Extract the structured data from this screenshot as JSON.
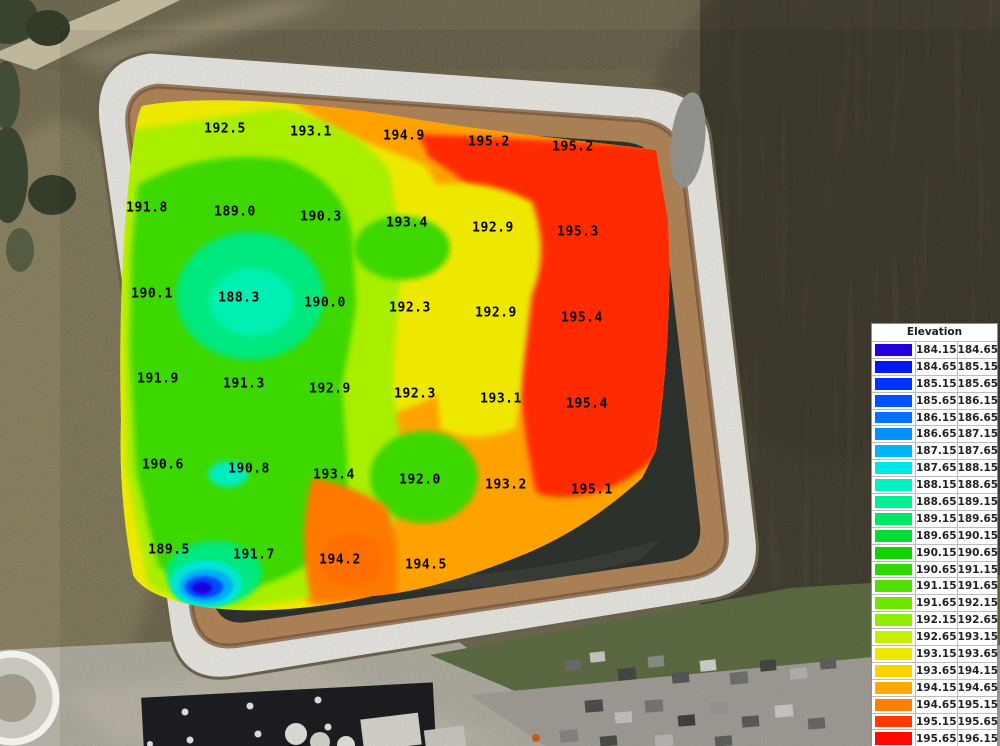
{
  "page": {
    "type": "elevation-survey-heatmap-over-aerial-photo",
    "accent_colors": {
      "legend_border": "#8f8f8f",
      "label_text": "#000000"
    }
  },
  "chart_data": {
    "type": "heatmap",
    "title": "Elevation",
    "legend_position": "right",
    "value_range": [
      184.15,
      196.15
    ],
    "bin_size": 0.5,
    "legend_bins": [
      {
        "from": "184.15",
        "to": "184.65",
        "color": "#2000DD"
      },
      {
        "from": "184.65",
        "to": "185.15",
        "color": "#0018F2"
      },
      {
        "from": "185.15",
        "to": "185.65",
        "color": "#0034FF"
      },
      {
        "from": "185.65",
        "to": "186.15",
        "color": "#0052FF"
      },
      {
        "from": "186.15",
        "to": "186.65",
        "color": "#0072FF"
      },
      {
        "from": "186.65",
        "to": "187.15",
        "color": "#0092FC"
      },
      {
        "from": "187.15",
        "to": "187.65",
        "color": "#00B6F5"
      },
      {
        "from": "187.65",
        "to": "188.15",
        "color": "#00E6E6"
      },
      {
        "from": "188.15",
        "to": "188.65",
        "color": "#00F2C0"
      },
      {
        "from": "188.65",
        "to": "189.15",
        "color": "#00EE94"
      },
      {
        "from": "189.15",
        "to": "189.65",
        "color": "#00E766"
      },
      {
        "from": "189.65",
        "to": "190.15",
        "color": "#00DD38"
      },
      {
        "from": "190.15",
        "to": "190.65",
        "color": "#10D400"
      },
      {
        "from": "190.65",
        "to": "191.15",
        "color": "#2ED900"
      },
      {
        "from": "191.15",
        "to": "191.65",
        "color": "#4EE000"
      },
      {
        "from": "191.65",
        "to": "192.15",
        "color": "#6EE800"
      },
      {
        "from": "192.15",
        "to": "192.65",
        "color": "#92EE00"
      },
      {
        "from": "192.65",
        "to": "193.15",
        "color": "#C8EE00"
      },
      {
        "from": "193.15",
        "to": "193.65",
        "color": "#EEE800"
      },
      {
        "from": "193.65",
        "to": "194.15",
        "color": "#FFD300"
      },
      {
        "from": "194.15",
        "to": "194.65",
        "color": "#FFA800"
      },
      {
        "from": "194.65",
        "to": "195.15",
        "color": "#FF7F00"
      },
      {
        "from": "195.15",
        "to": "195.65",
        "color": "#FF3A00"
      },
      {
        "from": "195.65",
        "to": "196.15",
        "color": "#FF0A00"
      }
    ],
    "points": [
      {
        "value": "192.5",
        "x": 225,
        "y": 129
      },
      {
        "value": "193.1",
        "x": 311,
        "y": 132
      },
      {
        "value": "194.9",
        "x": 404,
        "y": 136
      },
      {
        "value": "195.2",
        "x": 489,
        "y": 142
      },
      {
        "value": "195.2",
        "x": 573,
        "y": 147
      },
      {
        "value": "191.8",
        "x": 147,
        "y": 208
      },
      {
        "value": "189.0",
        "x": 235,
        "y": 212
      },
      {
        "value": "190.3",
        "x": 321,
        "y": 217
      },
      {
        "value": "193.4",
        "x": 407,
        "y": 223
      },
      {
        "value": "192.9",
        "x": 493,
        "y": 228
      },
      {
        "value": "195.3",
        "x": 578,
        "y": 232
      },
      {
        "value": "190.1",
        "x": 152,
        "y": 294
      },
      {
        "value": "188.3",
        "x": 239,
        "y": 298
      },
      {
        "value": "190.0",
        "x": 325,
        "y": 303
      },
      {
        "value": "192.3",
        "x": 410,
        "y": 308
      },
      {
        "value": "192.9",
        "x": 496,
        "y": 313
      },
      {
        "value": "195.4",
        "x": 582,
        "y": 318
      },
      {
        "value": "191.9",
        "x": 158,
        "y": 379
      },
      {
        "value": "191.3",
        "x": 244,
        "y": 384
      },
      {
        "value": "192.9",
        "x": 330,
        "y": 389
      },
      {
        "value": "192.3",
        "x": 415,
        "y": 394
      },
      {
        "value": "193.1",
        "x": 501,
        "y": 399
      },
      {
        "value": "195.4",
        "x": 587,
        "y": 404
      },
      {
        "value": "190.6",
        "x": 163,
        "y": 465
      },
      {
        "value": "190.8",
        "x": 249,
        "y": 469
      },
      {
        "value": "193.4",
        "x": 334,
        "y": 475
      },
      {
        "value": "192.0",
        "x": 420,
        "y": 480
      },
      {
        "value": "193.2",
        "x": 506,
        "y": 485
      },
      {
        "value": "195.1",
        "x": 592,
        "y": 490
      },
      {
        "value": "189.5",
        "x": 169,
        "y": 550
      },
      {
        "value": "191.7",
        "x": 254,
        "y": 555
      },
      {
        "value": "194.2",
        "x": 340,
        "y": 560
      },
      {
        "value": "194.5",
        "x": 426,
        "y": 565
      }
    ]
  }
}
